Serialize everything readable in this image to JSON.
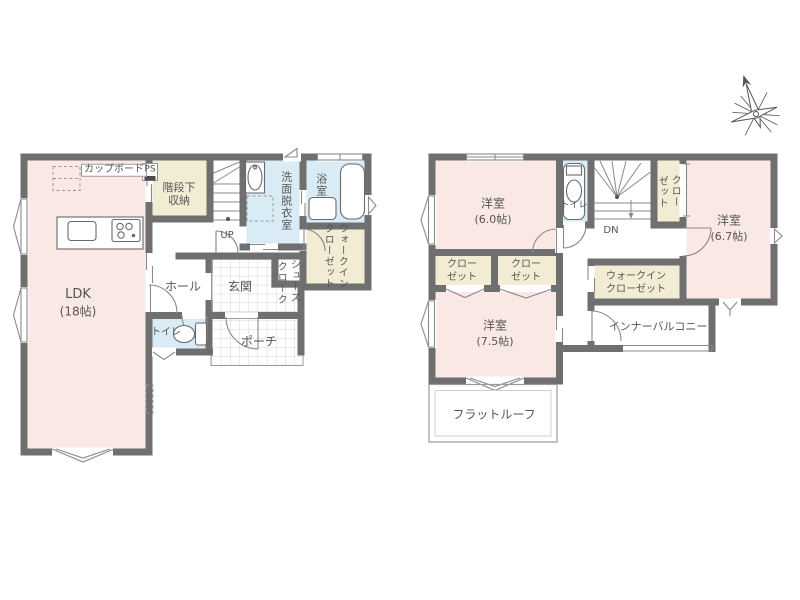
{
  "colors": {
    "wall": "#6f6f6f",
    "room": "#f9e8e4",
    "storage": "#f3ecd4",
    "wet": "#d9ebf4",
    "line": "#8a8a8a",
    "tile_line": "#d6d6d6",
    "text": "#555555"
  },
  "floor1": {
    "ldk_label": "LDK",
    "ldk_size": "(18帖)",
    "cupboard_label": "カップボード",
    "ps_label": "PS",
    "stair_storage_line1": "階段下",
    "stair_storage_line2": "収納",
    "up_label": "UP",
    "washroom_label": "洗面脱衣室",
    "bath_label": "浴室",
    "wic_line1": "ウォークイン",
    "wic_line2": "クローゼット",
    "shoes_line1": "シューズ",
    "shoes_line2": "クローク",
    "hall_label": "ホール",
    "genkan_label": "玄関",
    "toilet_label": "トイレ",
    "porch_label": "ポーチ"
  },
  "floor2": {
    "room_a_label": "洋室",
    "room_a_size": "(6.0帖)",
    "room_b_label": "洋室",
    "room_b_size": "(6.7帖)",
    "room_c_label": "洋室",
    "room_c_size": "(7.5帖)",
    "toilet_label": "トイレ",
    "dn_label": "DN",
    "closet_line1": "クロー",
    "closet_line2": "ゼット",
    "closet_a_line1": "クロー",
    "closet_a_line2": "ゼット",
    "closet_b_line1": "クロー",
    "closet_b_line2": "ゼット",
    "wic_line1": "ウォークイン",
    "wic_line2": "クローゼット",
    "balcony_label": "インナーバルコニー",
    "flat_roof_label": "フラットルーフ"
  }
}
